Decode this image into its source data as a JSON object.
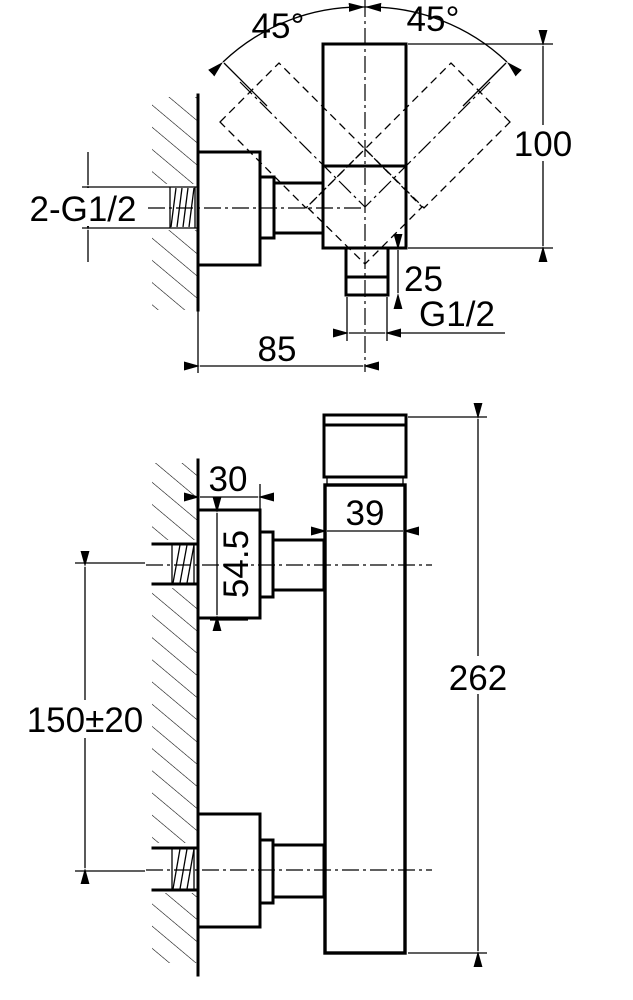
{
  "drawing": {
    "title": "Wall-mounted shower mixer installation drawing",
    "top_view": {
      "angle_left": "45°",
      "angle_right": "45°",
      "dim_height": "100",
      "dim_wall_thread": "2-G1/2",
      "dim_outlet_depth": "25",
      "dim_outlet_thread": "G1/2",
      "dim_wall_to_center": "85"
    },
    "front_view": {
      "dim_escutcheon_width": "30",
      "dim_body_width": "39",
      "dim_escutcheon_height": "54.5",
      "dim_inlet_spacing": "150±20",
      "dim_body_height": "262"
    }
  }
}
